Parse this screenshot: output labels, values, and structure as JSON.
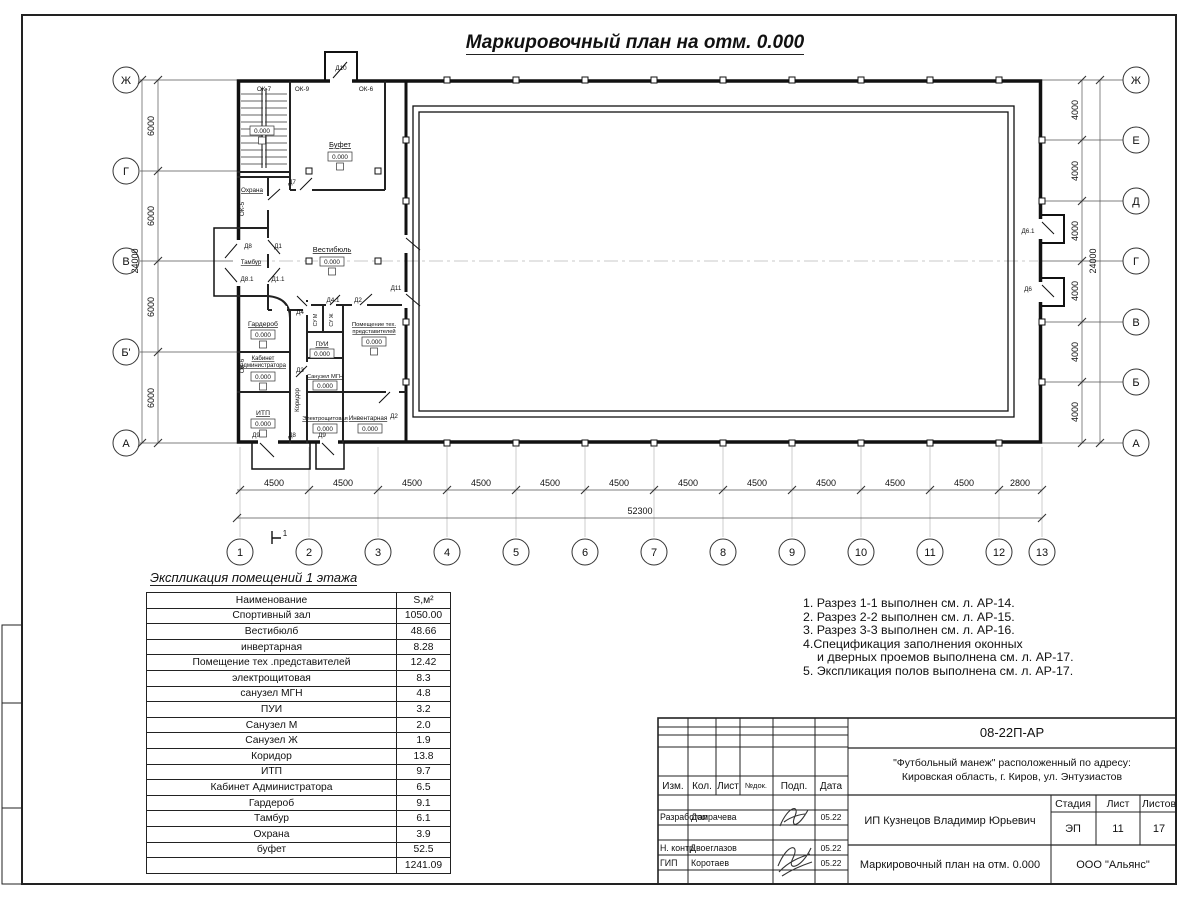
{
  "sheet": {
    "title": "Маркировочный план на отм. 0.000"
  },
  "plan": {
    "axes_left": [
      "Ж",
      "Г",
      "В",
      "Б'",
      "А"
    ],
    "axes_right": [
      "Ж",
      "Е",
      "Д",
      "Г",
      "В",
      "Б",
      "А"
    ],
    "grid": [
      "1",
      "2",
      "3",
      "4",
      "5",
      "6",
      "7",
      "8",
      "9",
      "10",
      "11",
      "12",
      "13"
    ],
    "dims_bottom": [
      "4500",
      "4500",
      "4500",
      "4500",
      "4500",
      "4500",
      "4500",
      "4500",
      "4500",
      "4500",
      "4500",
      "2800"
    ],
    "dim_bottom_total": "52300",
    "dims_left": [
      "6000",
      "6000",
      "6000",
      "6000"
    ],
    "dims_right": [
      "4000",
      "4000",
      "4000",
      "4000",
      "4000",
      "4000"
    ],
    "dim_side_total": "24000",
    "level": "0.000",
    "section_mark": "1",
    "rooms": {
      "bufet": "Буфет",
      "ohrana": "Охрана",
      "tambur": "Тамбур",
      "vestibul": "Вестибюль",
      "garderob": "Гардероб",
      "kabinet_1": "Кабинет",
      "kabinet_2": "администратора",
      "itp": "ИТП",
      "koridor": "Коридор",
      "su_m": "СУ М",
      "su_zh": "СУ Ж",
      "pui": "ПУИ",
      "su_mgn": "Санузел МГН",
      "pom_teh_1": "Помещение тех.",
      "pom_teh_2": "представителей",
      "electro": "Электрощитовая",
      "invent": "Инвентарная"
    },
    "openings": {
      "ok7": "ОК-7",
      "ok9": "ОК-9",
      "ok6": "ОК-6",
      "ok5": "ОК-5",
      "d1": "Д1",
      "d1_1": "Д1.1",
      "d2": "Д2",
      "d3": "Д3",
      "d4": "Д4",
      "d4_1": "Д4.1",
      "d6": "Д6",
      "d6_1": "Д6.1",
      "d7": "Д7",
      "d8": "Д8",
      "d8_1": "Д8.1",
      "d9": "Д9",
      "d10": "Д10",
      "d11": "Д11"
    }
  },
  "schedule": {
    "title": "Экспликация помещений 1 этажа",
    "col_name": "Наименование",
    "col_area": "S,м²",
    "rows": [
      {
        "n": "Спортивный зал",
        "s": "1050.00"
      },
      {
        "n": "Вестибюлб",
        "s": "48.66"
      },
      {
        "n": "инвертарная",
        "s": "8.28"
      },
      {
        "n": "Помещение тех .представителей",
        "s": "12.42"
      },
      {
        "n": "электрощитовая",
        "s": "8.3"
      },
      {
        "n": "санузел МГН",
        "s": "4.8"
      },
      {
        "n": "ПУИ",
        "s": "3.2"
      },
      {
        "n": "Санузел М",
        "s": "2.0"
      },
      {
        "n": "Санузел Ж",
        "s": "1.9"
      },
      {
        "n": "Коридор",
        "s": "13.8"
      },
      {
        "n": "ИТП",
        "s": "9.7"
      },
      {
        "n": "Кабинет Администратора",
        "s": "6.5"
      },
      {
        "n": "Гардероб",
        "s": "9.1"
      },
      {
        "n": "Тамбур",
        "s": "6.1"
      },
      {
        "n": "Охрана",
        "s": "3.9"
      },
      {
        "n": "буфет",
        "s": "52.5"
      }
    ],
    "total": "1241.09"
  },
  "notes": [
    "1. Разрез 1-1 выполнен см. л. АР-14.",
    "2. Разрез 2-2 выполнен см. л. АР-15.",
    "3. Разрез 3-3 выполнен см. л. АР-16.",
    "4.Спецификация заполнения оконных",
    "и дверных проемов выполнена см. л. АР-17.",
    "5. Экспликация полов выполнена см. л. АР-17."
  ],
  "titleblock": {
    "doc_number": "08-22П-АР",
    "project_line1": "\"Футбольный манеж\" расположенный по адресу:",
    "project_line2": "Кировская область, г. Киров, ул. Энтузиастов",
    "col_izm": "Изм.",
    "col_kol": "Кол.",
    "col_list": "Лист",
    "col_doc": "№док.",
    "col_podp": "Подп.",
    "col_data": "Дата",
    "row1_role": "Разработал",
    "row1_name": "Домрачева",
    "row2_role": "Н. контр.",
    "row2_name": "Двоеглазов",
    "row3_role": "ГИП",
    "row3_name": "Коротаев",
    "date": "05.22",
    "client": "ИП Кузнецов Владимир Юрьевич",
    "stage_label": "Стадия",
    "sheet_label": "Лист",
    "sheets_label": "Листов",
    "stage": "ЭП",
    "sheet_no": "11",
    "sheets_total": "17",
    "drawing_title": "Маркировочный план на отм. 0.000",
    "company": "ООО \"Альянс\""
  }
}
